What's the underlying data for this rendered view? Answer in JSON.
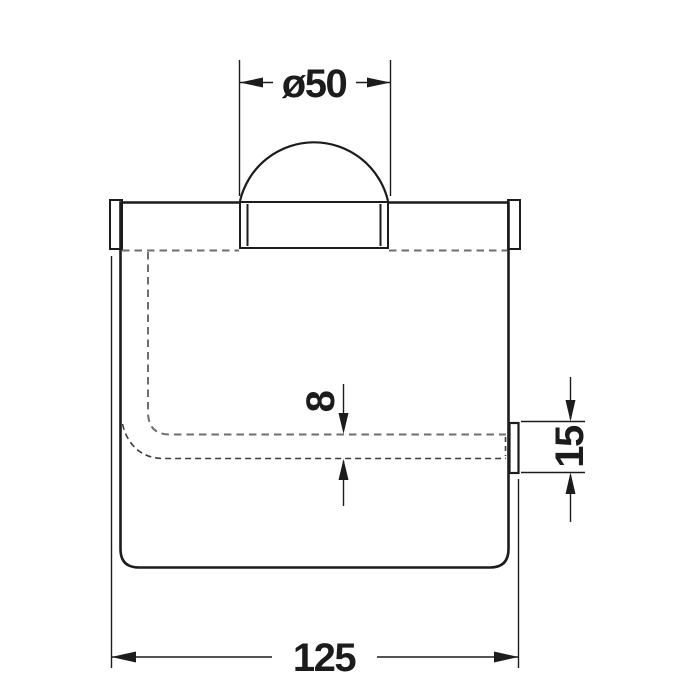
{
  "drawing": {
    "type": "technical-dimension-drawing",
    "subject": "wall-mounted paper holder with cover, front view",
    "dimensions": {
      "roll_diameter": "ø50",
      "cover_gap": "8",
      "button_height": "15",
      "overall_width": "125"
    },
    "colors": {
      "line": "#1c1c1c",
      "dashed_primary": "#6e6e6e",
      "dashed_secondary": "#3c3c3c",
      "background": "#ffffff"
    }
  }
}
